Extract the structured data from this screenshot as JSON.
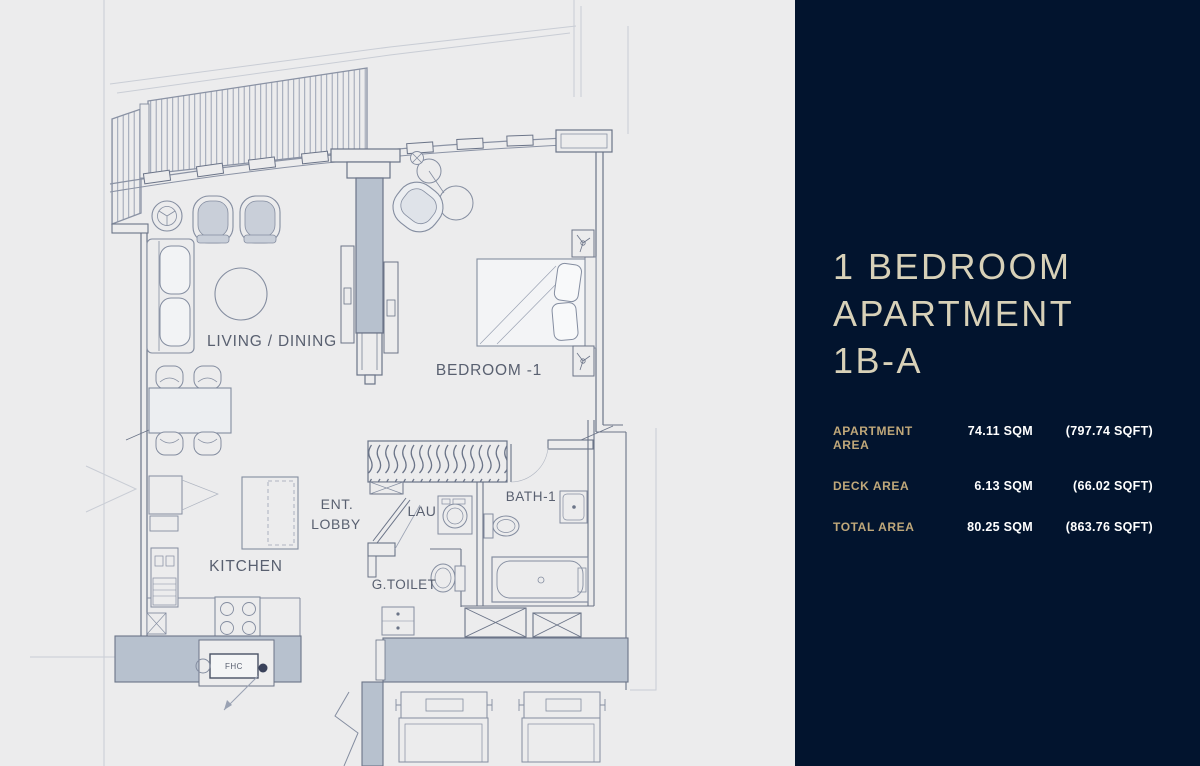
{
  "panel": {
    "title_lines": [
      "1 BEDROOM",
      "APARTMENT",
      "1B-A"
    ],
    "areas": [
      {
        "label": "APARTMENT AREA",
        "sqm": "74.11 SQM",
        "sqft": "(797.74 SQFT)"
      },
      {
        "label": "DECK AREA",
        "sqm": "6.13 SQM",
        "sqft": "(66.02 SQFT)"
      },
      {
        "label": "TOTAL AREA",
        "sqm": "80.25 SQM",
        "sqft": "(863.76 SQFT)"
      }
    ],
    "colors": {
      "background": "#02142e",
      "title": "#d8d1b8",
      "label": "#c0a87a",
      "value": "#ffffff"
    }
  },
  "floorplan": {
    "labels": {
      "living_dining": "LIVING / DINING",
      "bedroom": "BEDROOM -1",
      "kitchen": "KITCHEN",
      "ent_line1": "ENT.",
      "ent_line2": "LOBBY",
      "lau": "LAU",
      "bath": "BATH-1",
      "g_toilet": "G.TOILET",
      "fhc": "FHC"
    },
    "colors": {
      "line": "#848da0",
      "wall_stroke": "#6b7488",
      "wall_fill": "#b7c1ce",
      "background": "#ececed",
      "text": "#596070"
    }
  }
}
